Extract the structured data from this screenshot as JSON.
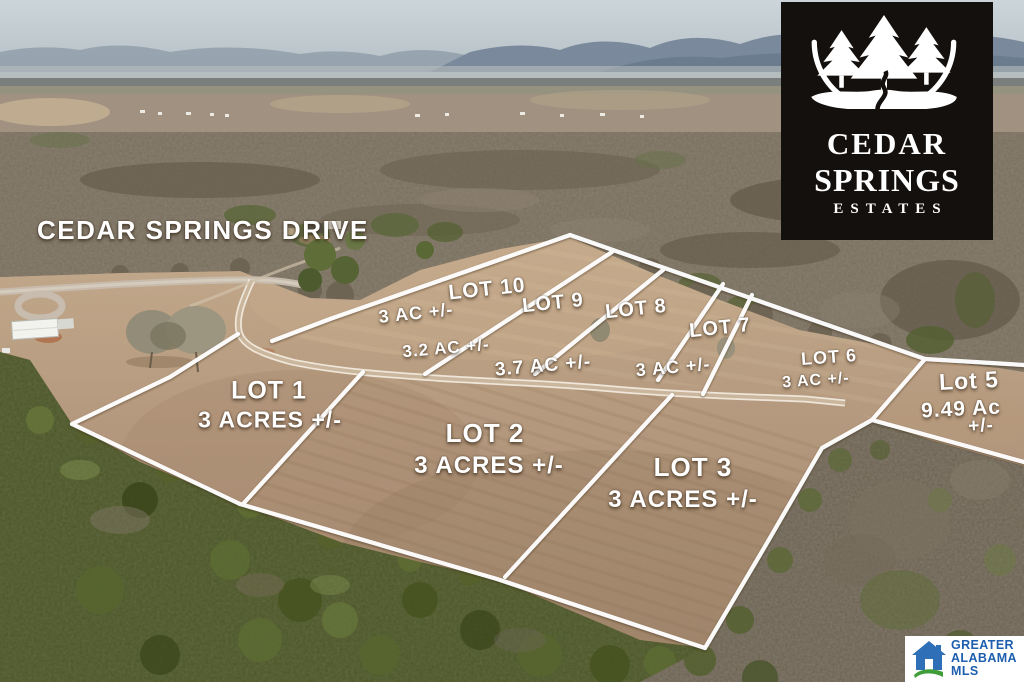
{
  "street_label": "CEDAR SPRINGS DRIVE",
  "lots": {
    "lot1": {
      "name": "LOT 1",
      "acres": "3 ACRES +/-"
    },
    "lot2": {
      "name": "LOT 2",
      "acres": "3 ACRES +/-"
    },
    "lot3": {
      "name": "LOT 3",
      "acres": "3 ACRES +/-"
    },
    "lot5": {
      "name": "Lot 5",
      "acres": "9.49 Ac",
      "acres2": "+/-"
    },
    "lot6": {
      "name": "LOT 6",
      "acres": "3 AC +/-"
    },
    "lot7": {
      "name": "LOT 7",
      "acres": "3 AC +/-"
    },
    "lot8": {
      "name": "LOT 8",
      "acres": "3.7 AC +/-"
    },
    "lot9": {
      "name": "LOT 9",
      "acres": "3.2 AC +/-"
    },
    "lot10": {
      "name": "LOT 10",
      "acres": "3 AC +/-"
    }
  },
  "logo": {
    "line1": "CEDAR",
    "line2": "SPRINGS",
    "line3": "ESTATES"
  },
  "mls": {
    "line1": "GREATER",
    "line2": "ALABAMA",
    "line3": "MLS"
  },
  "colors": {
    "boundary_line": "#ffffff",
    "label_text": "#ffffff",
    "logo_background": "#14100d",
    "logo_text": "#ffffff",
    "mls_blue": "#1d5fae",
    "mls_green": "#3f9e39"
  }
}
